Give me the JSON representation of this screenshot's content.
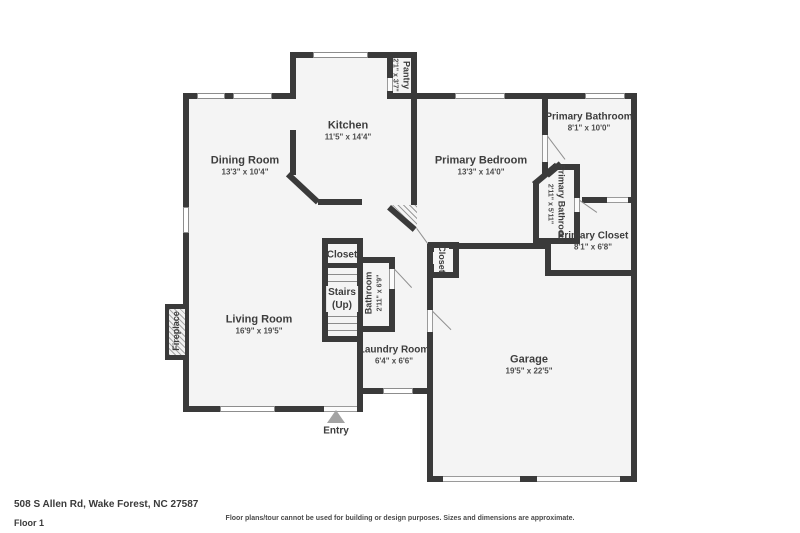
{
  "rooms": {
    "dining_room": {
      "name": "Dining Room",
      "dims": "13'3\" x 10'4\""
    },
    "kitchen": {
      "name": "Kitchen",
      "dims": "11'5\" x 14'4\""
    },
    "pantry": {
      "name": "Pantry",
      "dims": "2'1\" x 3'7\""
    },
    "primary_bedroom": {
      "name": "Primary Bedroom",
      "dims": "13'3\" x 14'0\""
    },
    "primary_bathroom": {
      "name": "Primary Bathroom",
      "dims": "8'1\" x 10'0\""
    },
    "primary_bathroom_2": {
      "name": "Primary Bathroom",
      "dims": "2'11\" x 5'11\""
    },
    "primary_closet": {
      "name": "Primary Closet",
      "dims": "8'1\" x 6'8\""
    },
    "closet_upper": {
      "name": "Closet"
    },
    "stairs": {
      "name": "Stairs",
      "sub": "(Up)"
    },
    "bathroom": {
      "name": "Bathroom",
      "dims": "2'11\" x 6'9\""
    },
    "living_room": {
      "name": "Living Room",
      "dims": "16'9\" x 19'5\""
    },
    "laundry_room": {
      "name": "Laundry Room",
      "dims": "6'4\" x 6'6\""
    },
    "garage": {
      "name": "Garage",
      "dims": "19'5\" x 22'5\""
    },
    "closet_hall": {
      "name": "Closet"
    },
    "fireplace": {
      "name": "Fireplace"
    },
    "entry": {
      "name": "Entry"
    }
  },
  "footer": {
    "address": "508 S Allen Rd, Wake Forest, NC 27587",
    "floor_label": "Floor 1",
    "disclaimer": "Floor plans/tour cannot be used for building or design purposes. Sizes and dimensions are approximate."
  },
  "colors": {
    "wall": "#3a3a3a",
    "room_fill": "#f4f4f4",
    "label_text": "#3d3d3d",
    "entry_arrow": "#a3a3a3"
  }
}
